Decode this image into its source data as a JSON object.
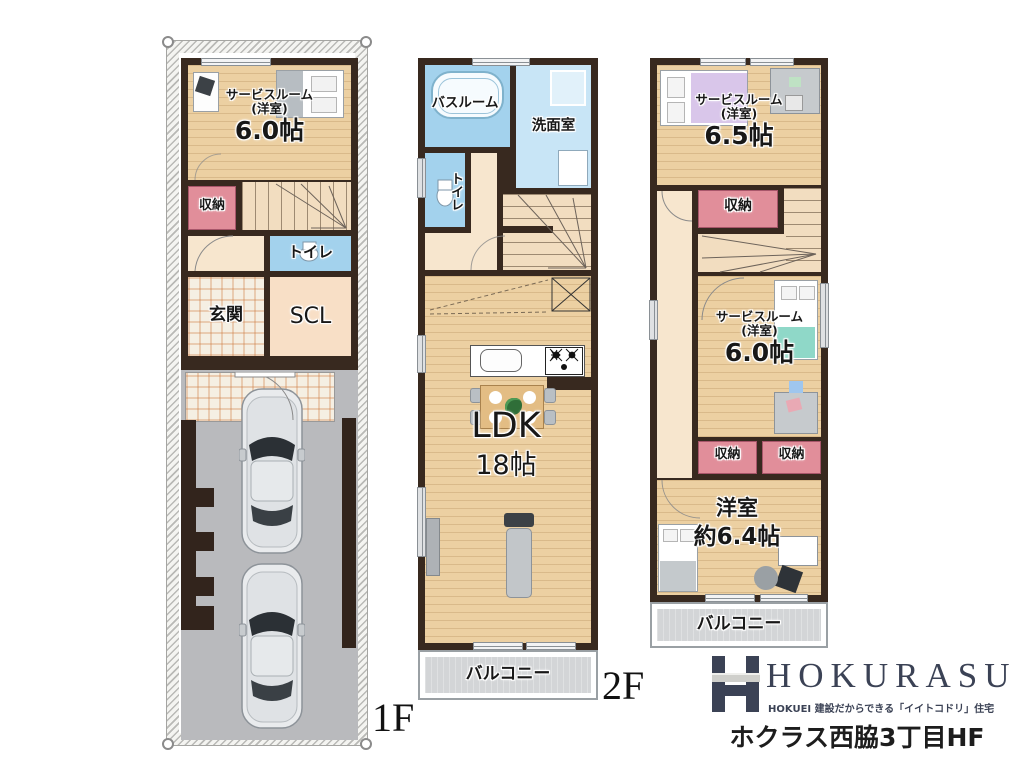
{
  "floors": {
    "f1": {
      "floor_label": "1F",
      "service_name": "サービスルーム",
      "service_sub": "(洋室)",
      "service_size": "6.0帖",
      "storage": "収納",
      "toilet": "トイレ",
      "entrance": "玄関",
      "scl": "SCL"
    },
    "f2": {
      "floor_label": "2F",
      "bath": "バスルーム",
      "wash": "洗面室",
      "toilet": "トイレ",
      "ldk_name": "LDK",
      "ldk_size": "18帖",
      "balcony": "バルコニー"
    },
    "f3": {
      "service65_name": "サービスルーム",
      "service65_sub": "(洋室)",
      "service65_size": "6.5帖",
      "storage_a": "収納",
      "service60_name": "サービスルーム",
      "service60_sub": "(洋室)",
      "service60_size": "6.0帖",
      "storage_b": "収納",
      "storage_c": "収納",
      "west_name": "洋室",
      "west_size": "約6.4帖",
      "balcony": "バルコニー"
    }
  },
  "logo": {
    "brand": "HOKURASU",
    "tagline": "HOKUEI 建設だからできる「イイトコドリ」住宅",
    "project": "ホクラス西脇3丁目HF"
  },
  "colors": {
    "wall": "#38291f",
    "wood": "#ecd0a2",
    "storage_pink": "#e18e9a",
    "water_blue": "#a3d2ed",
    "wash_blue": "#c8e5f6",
    "garage_gray": "#b9babd",
    "balcony_gray": "#d3d5d7",
    "logo_navy": "#3b4255"
  }
}
